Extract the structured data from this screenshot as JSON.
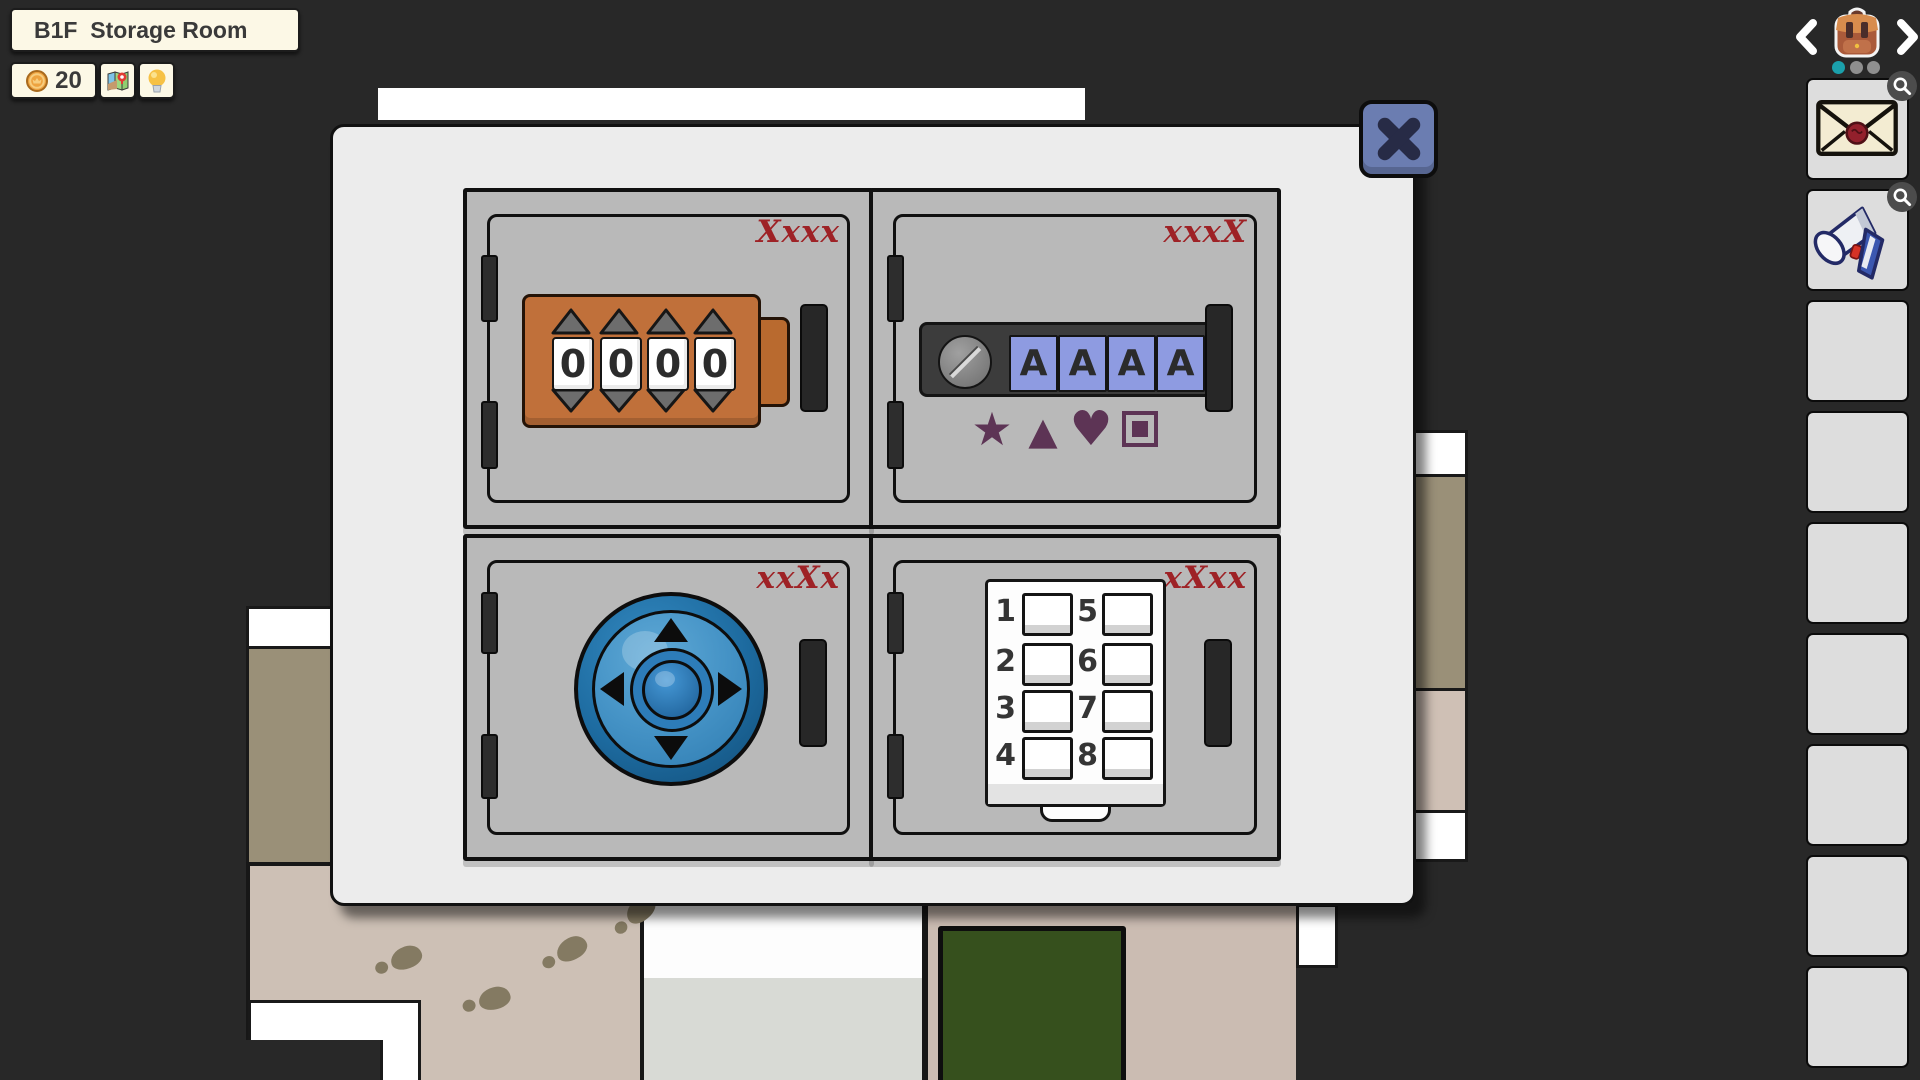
{
  "hud": {
    "room_label": "B1F  Storage Room",
    "coin_count": "20",
    "icons": {
      "coin": "coin-icon",
      "map": "map-icon",
      "hint": "lightbulb-icon"
    }
  },
  "sidebar": {
    "bag_icon": "backpack-icon",
    "prev_icon": "chevron-left-icon",
    "next_icon": "chevron-right-icon",
    "page_dots": [
      {
        "state": "active",
        "color": "#1ba0ab"
      },
      {
        "state": "inactive",
        "color": "#8f8f8f"
      },
      {
        "state": "inactive",
        "color": "#8f8f8f"
      }
    ],
    "slots": [
      {
        "item": "sealed-envelope",
        "has_zoom_badge": true
      },
      {
        "item": "heat-gun-tool",
        "has_zoom_badge": true
      },
      {
        "item": ""
      },
      {
        "item": ""
      },
      {
        "item": ""
      },
      {
        "item": ""
      },
      {
        "item": ""
      },
      {
        "item": ""
      },
      {
        "item": ""
      }
    ]
  },
  "modal": {
    "close_icon": "x-icon",
    "lockers": [
      {
        "position": "top-left",
        "code_hint": "Xxxx",
        "lock_type": "number-dial-lock",
        "dials": [
          "0",
          "0",
          "0",
          "0"
        ]
      },
      {
        "position": "top-right",
        "code_hint": "xxxX",
        "lock_type": "letter-button-lock",
        "buttons": [
          "A",
          "A",
          "A",
          "A"
        ],
        "symbols": [
          {
            "name": "star",
            "glyph": "★"
          },
          {
            "name": "triangle",
            "glyph": "▲"
          },
          {
            "name": "heart",
            "glyph": "♥"
          },
          {
            "name": "square",
            "glyph": ""
          }
        ]
      },
      {
        "position": "bottom-left",
        "code_hint": "xxXx",
        "lock_type": "direction-pad-lock",
        "directions": [
          "up",
          "left",
          "right",
          "down"
        ]
      },
      {
        "position": "bottom-right",
        "code_hint": "xXxx",
        "lock_type": "number-keypad-lock",
        "keys": [
          "1",
          "2",
          "3",
          "4",
          "5",
          "6",
          "7",
          "8"
        ]
      }
    ]
  },
  "colors": {
    "code_hint_red": "#9e2226",
    "locker_gray": "#b9b9b9",
    "modal_bg": "#ececec",
    "dial_lock_orange": "#c0703a",
    "letter_key_blue": "#8e9be1",
    "dpad_blue": "#2a80b8",
    "symbol_plum": "#5d3455",
    "close_button_blue": "#6b7db1",
    "hud_cream": "#fcf8e6",
    "active_dot_teal": "#1ba0ab",
    "rug_green": "#36501d"
  }
}
